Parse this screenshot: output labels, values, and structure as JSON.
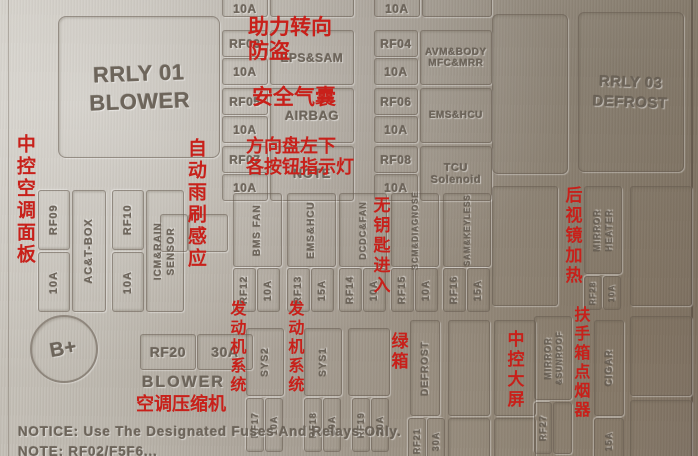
{
  "colors": {
    "annotation_red": "#c8201a",
    "panel_metal": "#aea79d",
    "engraving": "#6c6358"
  },
  "relays": {
    "rrly01_id": "RRLY 01",
    "rrly01_label": "BLOWER",
    "rrly03_id": "RRLY 03",
    "rrly03_label": "DEFROST"
  },
  "top_partial": {
    "amp_left": "10A",
    "amp_right": "10A"
  },
  "fuses": {
    "rf03": {
      "id": "RF03",
      "amp": "10A",
      "label": "EPS&SAM"
    },
    "rf04": {
      "id": "RF04",
      "amp": "10A",
      "label_1": "AVM&BODY",
      "label_2": "MFC&MRR"
    },
    "rf05": {
      "id": "RF05",
      "amp": "10A",
      "label": "AIRBAG"
    },
    "rf06": {
      "id": "RF06",
      "amp": "10A",
      "label": "EMS&HCU"
    },
    "rf07": {
      "id": "RF07",
      "amp": "10A",
      "label": "NOTE"
    },
    "rf08": {
      "id": "RF08",
      "amp": "10A",
      "label_1": "TCU",
      "label_2": "Solenoid"
    },
    "rf09": {
      "id": "RF09",
      "amp": "10A",
      "label": "AC&T-BOX"
    },
    "rf10": {
      "id": "RF10",
      "amp": "10A",
      "label_1": "ICM&RAIN",
      "label_2": "SENSOR"
    },
    "rf12": {
      "id": "RF12",
      "amp": "10A",
      "label": "BMS FAN"
    },
    "rf13": {
      "id": "RF13",
      "amp": "15A",
      "label": "EMS&HCU"
    },
    "rf14": {
      "id": "RF14",
      "amp": "10A",
      "label": "DCDC&FAN"
    },
    "rf15": {
      "id": "RF15",
      "amp": "10A",
      "label": "BCM&DIAGNOSE"
    },
    "rf16": {
      "id": "RF16",
      "amp": "15A",
      "label": "SAM&KEYLESS"
    },
    "rf17": {
      "id": "RF17",
      "amp": "10A",
      "label": "SYS2"
    },
    "rf18": {
      "id": "RF18",
      "amp": "20A",
      "label": "SYS1"
    },
    "rf19": {
      "id": "RF19",
      "amp": "20A"
    },
    "rf20": {
      "id": "RF20",
      "amp": "30A",
      "label": "BLOWER"
    },
    "rf21": {
      "id": "RF21",
      "amp": "30A",
      "label": "DEFROST"
    },
    "rf27": {
      "id": "RF27",
      "label_1": "MIRROR",
      "label_2": "&SUNROOF"
    },
    "rf28": {
      "id": "RF28",
      "amp": "10A",
      "label_1": "MIRROR",
      "label_2": "HEATER"
    },
    "cigar": {
      "label": "CIGAR",
      "amp": "15A"
    }
  },
  "annotations": {
    "ac_panel": "中控空调面板",
    "auto_wiper": "自动雨刷感应",
    "power_steering_1": "助力转向",
    "power_steering_2": "防盗",
    "airbag": "安全气囊",
    "steering_buttons_1": "方向盘左下",
    "steering_buttons_2": "各按钮指示灯",
    "keyless": "无钥匙进入",
    "engine_system_a": "发动机系统",
    "engine_system_b": "发动机系统",
    "ac_compressor": "空调压缩机",
    "green_box": "绿箱",
    "center_screen": "中控大屏",
    "mirror_heating": "后视镜加热",
    "armrest_cigar": "扶手箱点烟器"
  },
  "misc": {
    "battery_terminal": "B+"
  },
  "notices": {
    "line1": "NOTICE: Use The Designated Fuses And Relays Only.",
    "line2": "NOTE: RF02/F5F6..."
  }
}
